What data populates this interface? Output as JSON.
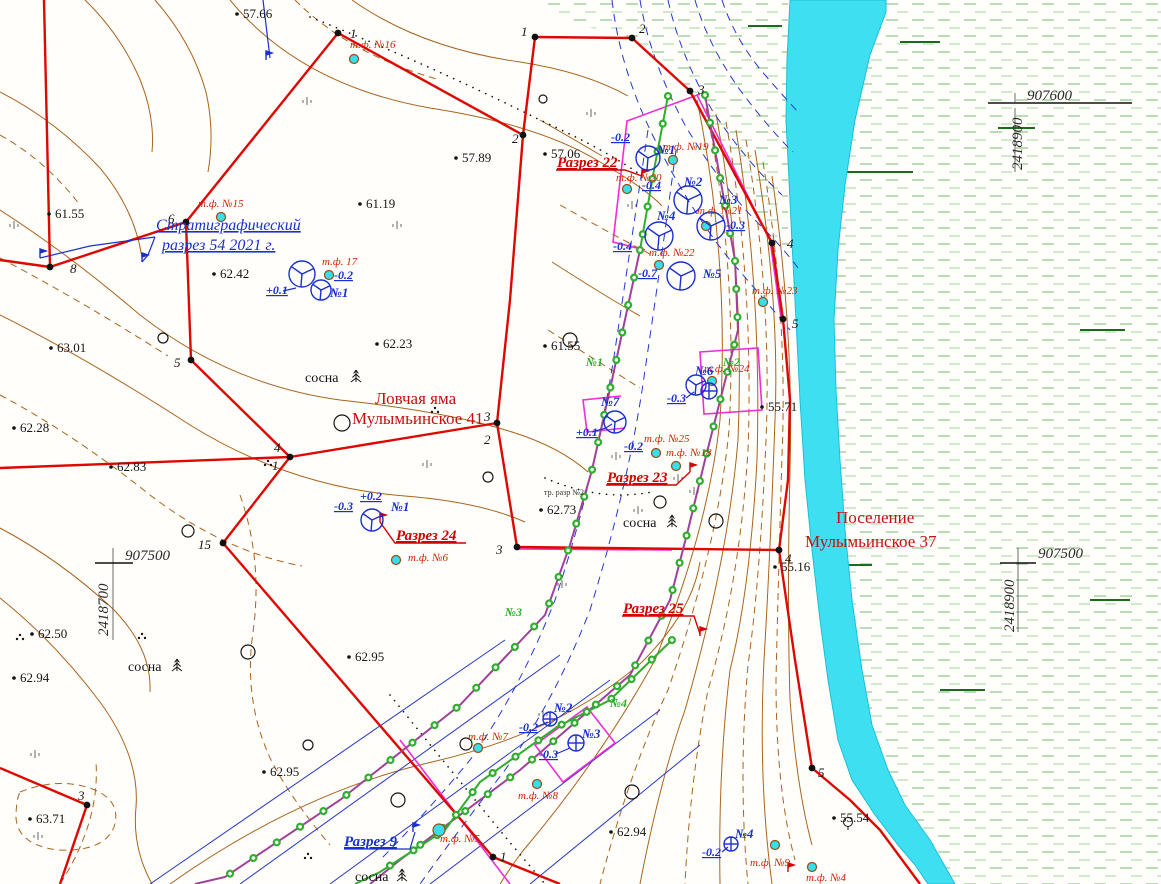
{
  "map": {
    "colors": {
      "river": "#3fdff2",
      "river_edge": "#19c0d8",
      "boundary_red": "#dd0800",
      "contour_brown": "#a8641f",
      "trench_purple": "#a0409a",
      "trench_green": "#2fae2f",
      "annotation_blue": "#1a2fd0",
      "label_red": "#cc2200",
      "survey_magenta": "#f02cd8",
      "wetland_green": "#9ccf9a",
      "survey_point_cyan": "#35e0ea"
    },
    "site_names": [
      "Ловчая яма Мулымьинское 41",
      "Поселение Мулымьинское 37"
    ],
    "labels": [
      {
        "text": "57.66",
        "x": 243,
        "y": 18,
        "cls": "elev"
      },
      {
        "text": "57.89",
        "x": 462,
        "y": 162,
        "cls": "elev"
      },
      {
        "text": "57.06",
        "x": 551,
        "y": 158,
        "cls": "elev"
      },
      {
        "text": "61.55",
        "x": 55,
        "y": 218,
        "cls": "elev"
      },
      {
        "text": "61.19",
        "x": 366,
        "y": 208,
        "cls": "elev"
      },
      {
        "text": "62.42",
        "x": 220,
        "y": 278,
        "cls": "elev"
      },
      {
        "text": "62.23",
        "x": 383,
        "y": 348,
        "cls": "elev"
      },
      {
        "text": "61.55",
        "x": 551,
        "y": 350,
        "cls": "elev"
      },
      {
        "text": "63.01",
        "x": 57,
        "y": 352,
        "cls": "elev"
      },
      {
        "text": "62.28",
        "x": 20,
        "y": 432,
        "cls": "elev"
      },
      {
        "text": "62.83",
        "x": 117,
        "y": 471,
        "cls": "elev"
      },
      {
        "text": "62.73",
        "x": 547,
        "y": 514,
        "cls": "elev"
      },
      {
        "text": "62.50",
        "x": 38,
        "y": 638,
        "cls": "elev"
      },
      {
        "text": "62.94",
        "x": 20,
        "y": 682,
        "cls": "elev"
      },
      {
        "text": "62.95",
        "x": 355,
        "y": 661,
        "cls": "elev"
      },
      {
        "text": "62.95",
        "x": 270,
        "y": 776,
        "cls": "elev"
      },
      {
        "text": "63.71",
        "x": 36,
        "y": 823,
        "cls": "elev"
      },
      {
        "text": "62.94",
        "x": 617,
        "y": 836,
        "cls": "elev"
      },
      {
        "text": "55.71",
        "x": 768,
        "y": 411,
        "cls": "elev"
      },
      {
        "text": "55.16",
        "x": 781,
        "y": 571,
        "cls": "elev"
      },
      {
        "text": "55.54",
        "x": 840,
        "y": 822,
        "cls": "elev"
      },
      {
        "text": "907600",
        "x": 1027,
        "y": 100,
        "cls": "grid"
      },
      {
        "text": "2418900",
        "x": 1022,
        "y": 170,
        "cls": "grid",
        "rot": -90
      },
      {
        "text": "907500",
        "x": 1038,
        "y": 558,
        "cls": "grid"
      },
      {
        "text": "2418900",
        "x": 1014,
        "y": 632,
        "cls": "grid",
        "rot": -90
      },
      {
        "text": "907500",
        "x": 125,
        "y": 560,
        "cls": "grid"
      },
      {
        "text": "2418700",
        "x": 108,
        "y": 636,
        "cls": "grid",
        "rot": -90
      },
      {
        "text": "Ловчая яма",
        "x": 375,
        "y": 404,
        "cls": "site"
      },
      {
        "text": "Мулымьинское 41",
        "x": 352,
        "y": 424,
        "cls": "site"
      },
      {
        "text": "Поселение",
        "x": 836,
        "y": 523,
        "cls": "site"
      },
      {
        "text": "Мулымьинское 37",
        "x": 805,
        "y": 547,
        "cls": "site"
      },
      {
        "text": "Разрез 22",
        "x": 557,
        "y": 167,
        "cls": "razrez"
      },
      {
        "text": "Разрез 23",
        "x": 607,
        "y": 482,
        "cls": "razrez"
      },
      {
        "text": "Разрез 24",
        "x": 396,
        "y": 540,
        "cls": "razrez"
      },
      {
        "text": "Разрез 25",
        "x": 623,
        "y": 613,
        "cls": "razrez"
      },
      {
        "text": "Разрез 9",
        "x": 344,
        "y": 846,
        "cls": "razrez-blue"
      },
      {
        "text": "Стратиграфический",
        "x": 156,
        "y": 230,
        "cls": "strat"
      },
      {
        "text": "разрез 54 2021 г.",
        "x": 162,
        "y": 250,
        "cls": "strat"
      },
      {
        "text": "т.ф. №16",
        "x": 350,
        "y": 48,
        "cls": "tf"
      },
      {
        "text": "т.ф. №15",
        "x": 198,
        "y": 207,
        "cls": "tf"
      },
      {
        "text": "т.ф. 17",
        "x": 322,
        "y": 265,
        "cls": "tf"
      },
      {
        "text": "т.ф. №19",
        "x": 663,
        "y": 150,
        "cls": "tf"
      },
      {
        "text": "т.ф. №20",
        "x": 616,
        "y": 181,
        "cls": "tf"
      },
      {
        "text": "т.ф. №21",
        "x": 697,
        "y": 214,
        "cls": "tf"
      },
      {
        "text": "т.ф. №22",
        "x": 649,
        "y": 256,
        "cls": "tf"
      },
      {
        "text": "т.ф. №23",
        "x": 752,
        "y": 294,
        "cls": "tf"
      },
      {
        "text": "т.ф. №24",
        "x": 704,
        "y": 372,
        "cls": "tf"
      },
      {
        "text": "т.ф. №25",
        "x": 644,
        "y": 442,
        "cls": "tf"
      },
      {
        "text": "т.ф. №18",
        "x": 666,
        "y": 456,
        "cls": "tf"
      },
      {
        "text": "т.ф. №6",
        "x": 408,
        "y": 561,
        "cls": "tf"
      },
      {
        "text": "т.ф. №7",
        "x": 468,
        "y": 740,
        "cls": "tf"
      },
      {
        "text": "т.ф. №8",
        "x": 518,
        "y": 799,
        "cls": "tf"
      },
      {
        "text": "т.ф. №5",
        "x": 440,
        "y": 842,
        "cls": "tf"
      },
      {
        "text": "т.ф. №9",
        "x": 750,
        "y": 866,
        "cls": "tf"
      },
      {
        "text": "т.ф. №4",
        "x": 806,
        "y": 881,
        "cls": "tf"
      },
      {
        "text": "№1",
        "x": 657,
        "y": 154,
        "cls": "pit"
      },
      {
        "text": "№2",
        "x": 684,
        "y": 186,
        "cls": "pit"
      },
      {
        "text": "№3",
        "x": 719,
        "y": 204,
        "cls": "pit"
      },
      {
        "text": "№4",
        "x": 657,
        "y": 220,
        "cls": "pit"
      },
      {
        "text": "№5",
        "x": 703,
        "y": 278,
        "cls": "pit"
      },
      {
        "text": "№1",
        "x": 330,
        "y": 297,
        "cls": "pit"
      },
      {
        "text": "№7",
        "x": 601,
        "y": 406,
        "cls": "pit"
      },
      {
        "text": "№6",
        "x": 695,
        "y": 375,
        "cls": "pit"
      },
      {
        "text": "№1",
        "x": 391,
        "y": 511,
        "cls": "pit"
      },
      {
        "text": "№2",
        "x": 554,
        "y": 712,
        "cls": "pit"
      },
      {
        "text": "№3",
        "x": 582,
        "y": 738,
        "cls": "pit"
      },
      {
        "text": "№4",
        "x": 735,
        "y": 838,
        "cls": "pit"
      },
      {
        "text": "-0.2",
        "x": 611,
        "y": 141,
        "cls": "off"
      },
      {
        "text": "-0.4",
        "x": 642,
        "y": 189,
        "cls": "off"
      },
      {
        "text": "-0.3",
        "x": 726,
        "y": 229,
        "cls": "off"
      },
      {
        "text": "-0.4",
        "x": 613,
        "y": 250,
        "cls": "off"
      },
      {
        "text": "-0.7",
        "x": 638,
        "y": 277,
        "cls": "off"
      },
      {
        "text": "+0.1",
        "x": 266,
        "y": 294,
        "cls": "off"
      },
      {
        "text": "-0.2",
        "x": 334,
        "y": 279,
        "cls": "off"
      },
      {
        "text": "+0.1",
        "x": 576,
        "y": 436,
        "cls": "off"
      },
      {
        "text": "-0.2",
        "x": 624,
        "y": 450,
        "cls": "off"
      },
      {
        "text": "-0.3",
        "x": 667,
        "y": 402,
        "cls": "off"
      },
      {
        "text": "-0.3",
        "x": 334,
        "y": 510,
        "cls": "off"
      },
      {
        "text": "+0.2",
        "x": 360,
        "y": 500,
        "cls": "off"
      },
      {
        "text": "-0.2",
        "x": 519,
        "y": 731,
        "cls": "off"
      },
      {
        "text": "-0.3",
        "x": 539,
        "y": 758,
        "cls": "off"
      },
      {
        "text": "-0.2",
        "x": 702,
        "y": 856,
        "cls": "off"
      },
      {
        "text": "№1",
        "x": 586,
        "y": 366,
        "cls": "gr"
      },
      {
        "text": "№2",
        "x": 723,
        "y": 366,
        "cls": "gr"
      },
      {
        "text": "№3",
        "x": 505,
        "y": 616,
        "cls": "gr"
      },
      {
        "text": "№4",
        "x": 610,
        "y": 707,
        "cls": "gr"
      },
      {
        "text": "1",
        "x": 350,
        "y": 38,
        "cls": "vx"
      },
      {
        "text": "2",
        "x": 512,
        "y": 143,
        "cls": "vx"
      },
      {
        "text": "6",
        "x": 168,
        "y": 223,
        "cls": "vx"
      },
      {
        "text": "8",
        "x": 70,
        "y": 273,
        "cls": "vx"
      },
      {
        "text": "5",
        "x": 174,
        "y": 367,
        "cls": "vx"
      },
      {
        "text": "4",
        "x": 274,
        "y": 452,
        "cls": "vx"
      },
      {
        "text": "1",
        "x": 272,
        "y": 470,
        "cls": "vx"
      },
      {
        "text": "15",
        "x": 198,
        "y": 549,
        "cls": "vx"
      },
      {
        "text": "3",
        "x": 484,
        "y": 421,
        "cls": "vx"
      },
      {
        "text": "2",
        "x": 484,
        "y": 444,
        "cls": "vx"
      },
      {
        "text": "3",
        "x": 496,
        "y": 554,
        "cls": "vx"
      },
      {
        "text": "3",
        "x": 78,
        "y": 800,
        "cls": "vx"
      },
      {
        "text": "1",
        "x": 500,
        "y": 861,
        "cls": "vx"
      },
      {
        "text": "1",
        "x": 521,
        "y": 36,
        "cls": "vx"
      },
      {
        "text": "2",
        "x": 639,
        "y": 33,
        "cls": "vx"
      },
      {
        "text": "3",
        "x": 698,
        "y": 94,
        "cls": "vx"
      },
      {
        "text": "4",
        "x": 787,
        "y": 248,
        "cls": "vx"
      },
      {
        "text": "5",
        "x": 792,
        "y": 328,
        "cls": "vx"
      },
      {
        "text": "4",
        "x": 785,
        "y": 563,
        "cls": "vx"
      },
      {
        "text": "5",
        "x": 818,
        "y": 777,
        "cls": "vx"
      },
      {
        "text": "сосна",
        "x": 305,
        "y": 382,
        "cls": "tree-label"
      },
      {
        "text": "сосна",
        "x": 128,
        "y": 671,
        "cls": "tree-label"
      },
      {
        "text": "сосна",
        "x": 623,
        "y": 527,
        "cls": "tree-label"
      },
      {
        "text": "сосна",
        "x": 355,
        "y": 881,
        "cls": "tree-label"
      },
      {
        "text": "тр. разр №2",
        "x": 544,
        "y": 495,
        "cls": "tiny"
      }
    ],
    "points": {
      "survey_photo_points": [
        [
          354,
          59
        ],
        [
          221,
          217
        ],
        [
          329,
          275
        ],
        [
          673,
          160
        ],
        [
          627,
          189
        ],
        [
          706,
          226
        ],
        [
          659,
          265
        ],
        [
          763,
          302
        ],
        [
          712,
          381
        ],
        [
          656,
          453
        ],
        [
          676,
          466
        ],
        [
          396,
          560
        ],
        [
          478,
          748
        ],
        [
          537,
          784
        ],
        [
          439,
          830,
          6
        ],
        [
          775,
          845
        ],
        [
          812,
          867
        ]
      ],
      "boundary_vertices": [
        [
          338,
          33
        ],
        [
          523,
          135
        ],
        [
          186,
          222
        ],
        [
          50,
          267
        ],
        [
          191,
          360
        ],
        [
          290,
          457
        ],
        [
          223,
          543
        ],
        [
          497,
          423
        ],
        [
          517,
          547
        ],
        [
          87,
          805
        ],
        [
          493,
          857
        ],
        [
          535,
          37
        ],
        [
          632,
          38
        ],
        [
          690,
          91
        ],
        [
          772,
          243
        ],
        [
          783,
          319
        ],
        [
          779,
          550
        ],
        [
          812,
          768
        ]
      ],
      "excavation_pits": [
        [
          648,
          158,
          12
        ],
        [
          688,
          200,
          14
        ],
        [
          711,
          226,
          14
        ],
        [
          659,
          236,
          14
        ],
        [
          681,
          276,
          14
        ],
        [
          302,
          274,
          13
        ],
        [
          321,
          290,
          10
        ],
        [
          372,
          520,
          11
        ],
        [
          615,
          422,
          11
        ],
        [
          696,
          385,
          10
        ],
        [
          709,
          391,
          8
        ],
        [
          550,
          719,
          7
        ],
        [
          576,
          743,
          8
        ],
        [
          731,
          844,
          7
        ]
      ],
      "open_circles": [
        [
          342,
          423,
          8
        ],
        [
          570,
          340,
          7
        ],
        [
          716,
          521,
          7
        ],
        [
          632,
          792,
          7
        ],
        [
          398,
          800,
          7
        ],
        [
          466,
          744,
          6
        ],
        [
          248,
          652,
          7
        ],
        [
          163,
          338,
          5
        ],
        [
          660,
          502,
          6
        ],
        [
          488,
          477,
          5
        ],
        [
          308,
          745,
          5
        ],
        [
          188,
          531,
          6
        ],
        [
          543,
          99,
          4
        ]
      ]
    }
  }
}
